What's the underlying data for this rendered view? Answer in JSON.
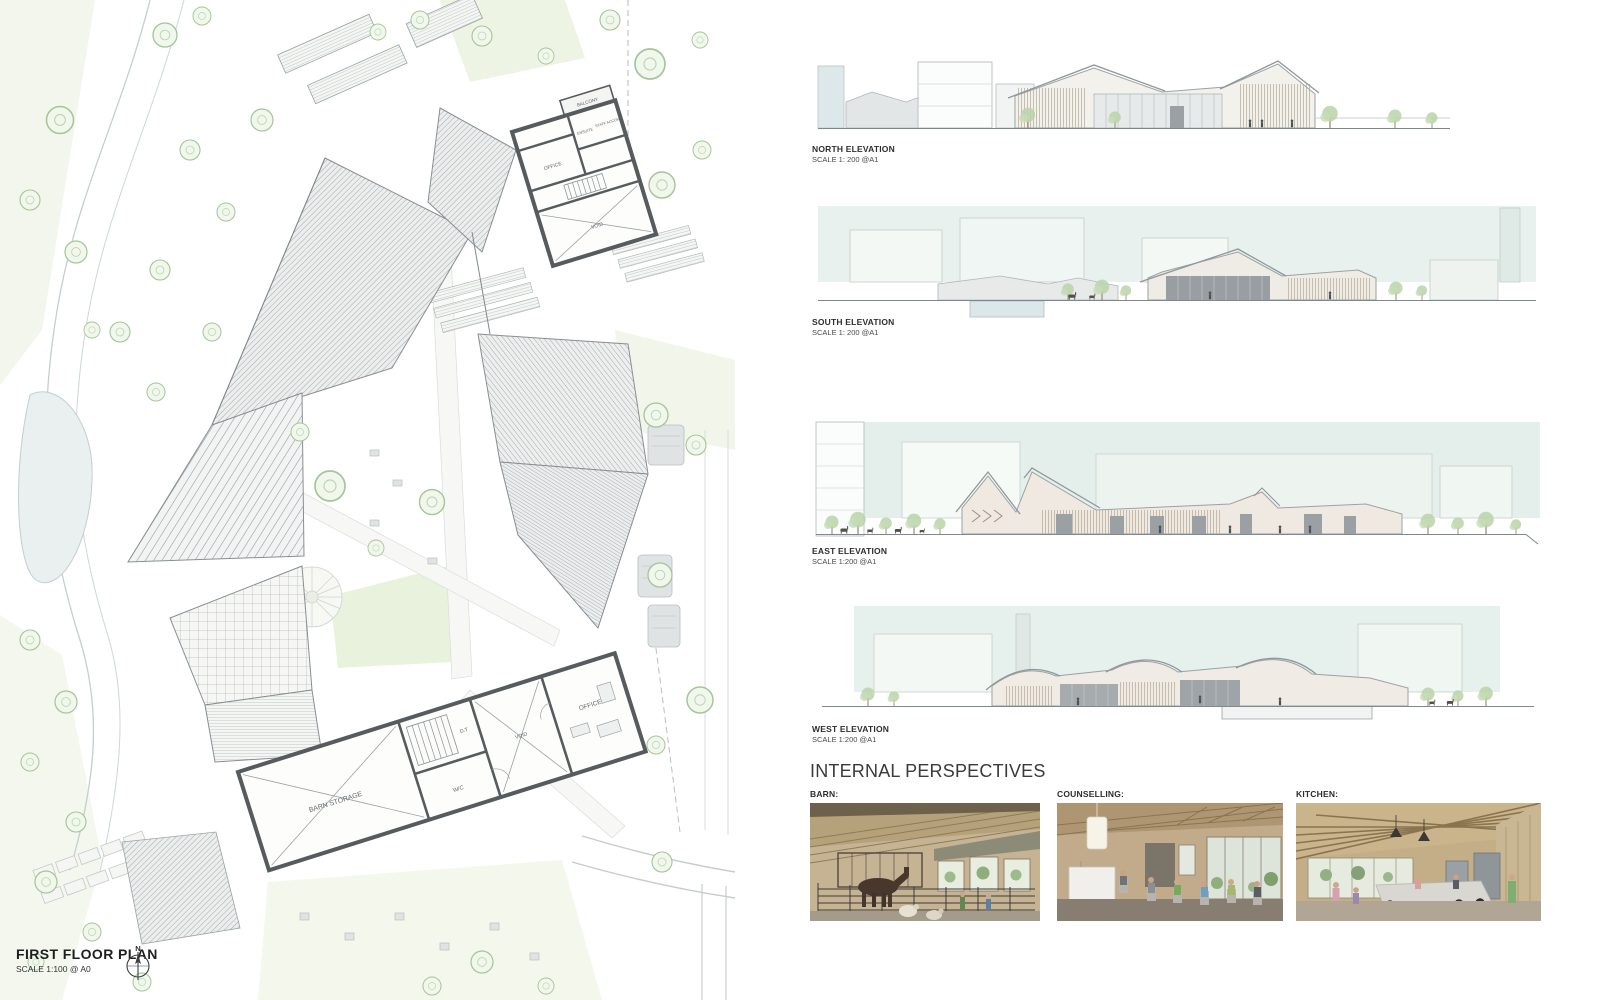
{
  "plan": {
    "title": "FIRST FLOOR PLAN",
    "scale": "SCALE 1:100 @ A0",
    "north": "N",
    "rooms": {
      "balcony": "BALCONY",
      "ensuite": "ENSUITE",
      "staff_accom": "STAFF ACCOM",
      "office_upper": "OFFICE",
      "void_upper": "VOID",
      "dt": "D.T",
      "wc": "W/C",
      "void_lower": "VOID",
      "barn_storage": "BARN STORAGE",
      "office_lower": "OFFICE"
    }
  },
  "elevations": [
    {
      "name": "NORTH ELEVATION",
      "scale": "SCALE 1: 200 @A1"
    },
    {
      "name": "SOUTH ELEVATION",
      "scale": "SCALE 1: 200 @A1"
    },
    {
      "name": "EAST ELEVATION",
      "scale": "SCALE 1:200 @A1"
    },
    {
      "name": "WEST ELEVATION",
      "scale": "SCALE 1:200 @A1"
    }
  ],
  "perspectives": {
    "heading": "INTERNAL PERSPECTIVES",
    "items": [
      {
        "label": "BARN:"
      },
      {
        "label": "COUNSELLING:"
      },
      {
        "label": "KITCHEN:"
      }
    ]
  },
  "colors": {
    "mint_band": "#e6f0ec",
    "roof_hatch_line": "#9aa2a5",
    "wall_dark": "#565b5e",
    "tree_green": "#a6c497",
    "timber": "#cdb896",
    "ground_line": "#7f888c",
    "paper": "#ffffff"
  }
}
